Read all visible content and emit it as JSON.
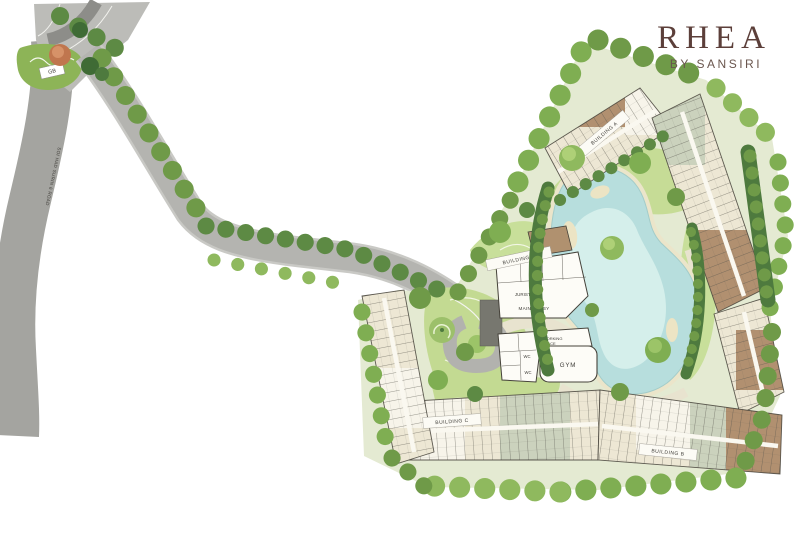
{
  "brand": {
    "name": "RHEA",
    "tagline": "BY SANSIRI"
  },
  "road": {
    "label": "SOI HAD SURIN 6 ROAD"
  },
  "entrance": {
    "guard_booth_label": "GB"
  },
  "buildings": {
    "building_a": "BUILDING A",
    "building_b": "BUILDING B",
    "building_c": "BUILDING C",
    "building_d": "BUILDING D"
  },
  "facilities": {
    "juristic": "JURISTIC",
    "main_lobby": "MAIN LOBBY",
    "coworking_line1": "CO-WORKING",
    "coworking_line2": "SPACE",
    "wc_upper": "WC",
    "wc_lower": "WC",
    "gym": "GYM"
  },
  "colors": {
    "brand": "#5c3f3a",
    "pool_water": "#b7dedd",
    "lawn": "#c6dc96",
    "road": "#a4a4a0",
    "tree": "#6f9a48"
  }
}
